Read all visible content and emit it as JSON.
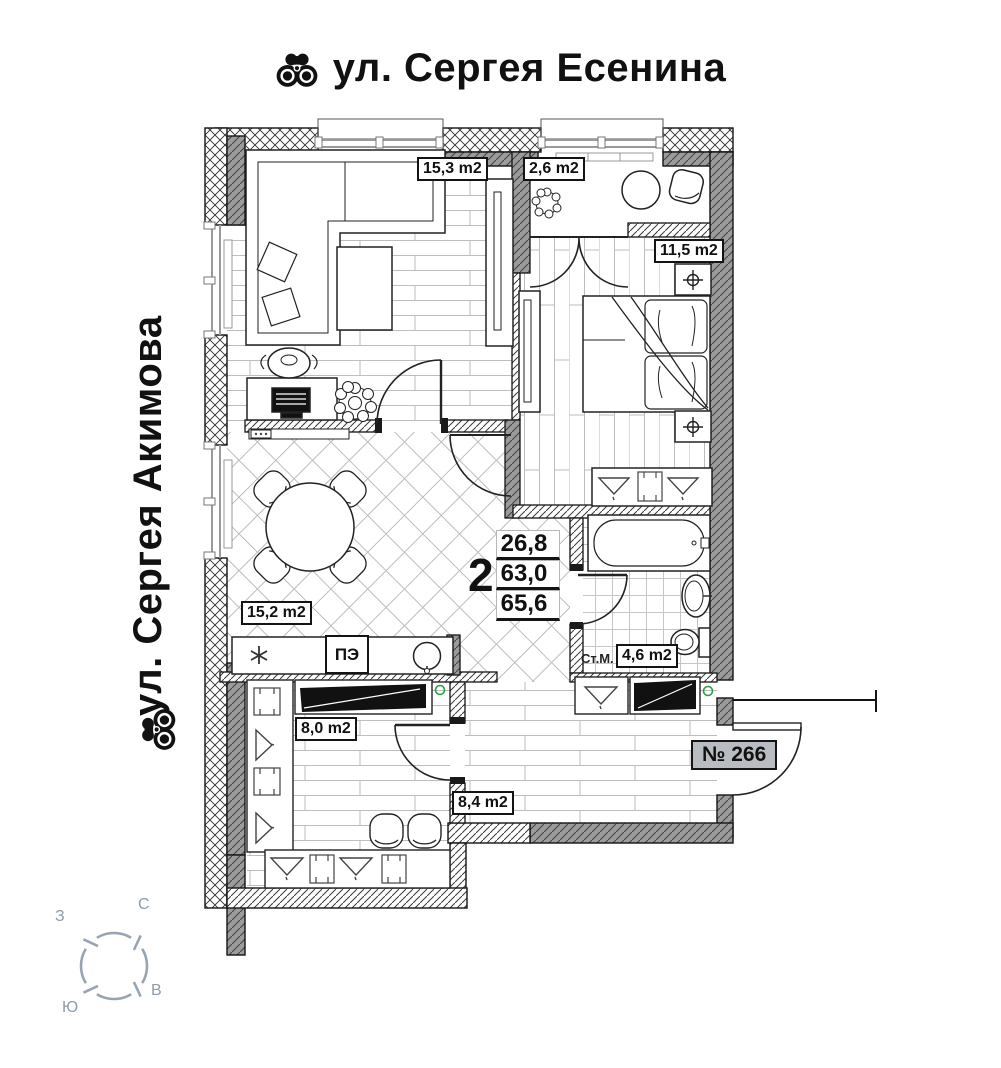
{
  "streets": {
    "top": "ул. Сергея Есенина",
    "left": "ул. Сергея Акимова"
  },
  "compass": {
    "west": "З",
    "north": "С",
    "east": "В",
    "south": "Ю"
  },
  "unit": {
    "number": "№ 266",
    "rooms": "2",
    "living_area": "26,8",
    "area_without_balcony": "63,0",
    "total_area": "65,6"
  },
  "rooms": {
    "living": "15,3 m2",
    "balcony": "2,6 m2",
    "bedroom": "11,5 m2",
    "kitchen": "15,2 m2",
    "dressing": "8,0 m2",
    "hall": "8,4 m2",
    "bathroom": "4,6 m2"
  },
  "appliances": {
    "stove": "ПЭ",
    "washing_machine": "Ст.М."
  },
  "icons": {
    "binoculars": "binoculars-icon",
    "fridge": "snowflake-icon",
    "ceiling_light": "crosshair-light-icon"
  },
  "colors": {
    "wall_gray": "#9b9b9b",
    "floor_line": "#bdbdbd",
    "compass_gray": "#97a5b2",
    "badge_bg": "#b9bdc1",
    "green_marker": "#2e9e44"
  }
}
